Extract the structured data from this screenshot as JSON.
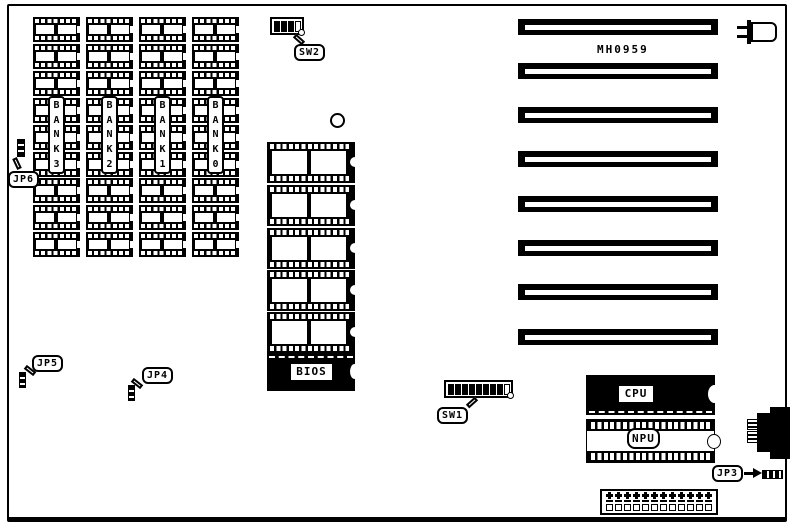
{
  "diagram": {
    "model": "MH0959",
    "banks": [
      {
        "label": "BANK3"
      },
      {
        "label": "BANK2"
      },
      {
        "label": "BANK1"
      },
      {
        "label": "BANK0"
      }
    ],
    "memory": {
      "columns": 4,
      "sockets_per_column": 9
    },
    "expansion_slots": {
      "count": 8
    },
    "center_sockets": {
      "count": 5
    },
    "chips": {
      "bios": "BIOS",
      "cpu": "CPU",
      "npu": "NPU"
    },
    "switches": {
      "sw1": {
        "label": "SW1",
        "dark_cells": 8,
        "light_cells": 1
      },
      "sw2": {
        "label": "SW2",
        "dark_cells": 3,
        "light_cells": 1
      }
    },
    "jumpers": {
      "jp3": {
        "label": "JP3"
      },
      "jp4": {
        "label": "JP4"
      },
      "jp5": {
        "label": "JP5"
      },
      "jp6": {
        "label": "JP6"
      }
    },
    "power_connector": {
      "pin_count": 12
    },
    "colors": {
      "ink": "#000000",
      "paper": "#ffffff"
    }
  }
}
